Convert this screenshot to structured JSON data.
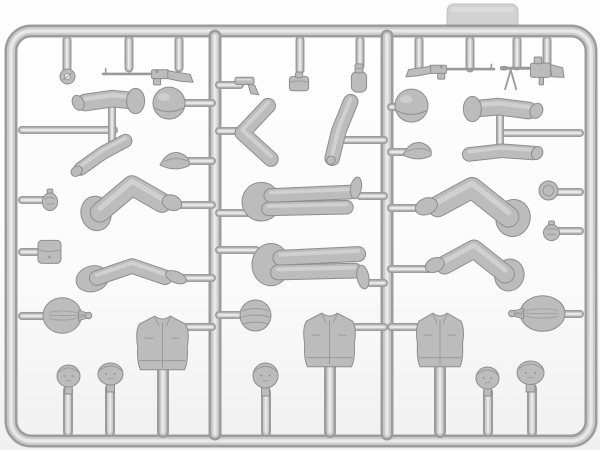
{
  "photo": {
    "subject": "model-kit-sprue-with-soldier-figure-parts",
    "plastic_color_name": "light-gray"
  },
  "palette": {
    "background_top": "#fefefe",
    "background_mid": "#fbfbfb",
    "background_bottom": "#f0f0f0",
    "runner_outline": "#9c9c9c",
    "runner_core": "#cbcbcb",
    "runner_highlight": "#e8e8e8",
    "plastic_base": "#bcbcbc",
    "plastic_edge": "#8d8d8d",
    "plastic_dark": "#999999",
    "plastic_highlight": "#dcdcdc",
    "tab_fill": "#d2d2d2",
    "tab_edge": "#c0c0c0",
    "shadow": "#d6d6d6"
  },
  "sprue": {
    "frame": {
      "x": 11,
      "y": 31,
      "w": 580,
      "h": 410,
      "radius": 20,
      "thickness": 13
    },
    "tab": {
      "x": 447,
      "y": 4,
      "w": 71,
      "h": 32,
      "radius": 7
    },
    "runners": [
      {
        "x": 215,
        "y1": 36,
        "y2": 434,
        "w": 13
      },
      {
        "x": 387,
        "y1": 36,
        "y2": 434,
        "w": 13
      }
    ],
    "stubs": [
      {
        "x": 67,
        "y1": 40,
        "y2": 72
      },
      {
        "x": 129,
        "y1": 40,
        "y2": 68
      },
      {
        "x": 179,
        "y1": 40,
        "y2": 68
      },
      {
        "x": 300,
        "y1": 40,
        "y2": 70
      },
      {
        "x": 360,
        "y1": 40,
        "y2": 66
      },
      {
        "x": 419,
        "y1": 40,
        "y2": 68
      },
      {
        "x": 470,
        "y1": 40,
        "y2": 68
      },
      {
        "x": 517,
        "y1": 40,
        "y2": 66
      },
      {
        "x": 547,
        "y1": 40,
        "y2": 66
      }
    ],
    "branches": [
      {
        "x1": 22,
        "x2": 114,
        "y": 130
      },
      {
        "x1": 22,
        "x2": 44,
        "y": 200
      },
      {
        "x1": 22,
        "x2": 42,
        "y": 252
      },
      {
        "x1": 22,
        "x2": 50,
        "y": 316
      },
      {
        "x1": 183,
        "x2": 212,
        "y": 103
      },
      {
        "x1": 189,
        "x2": 212,
        "y": 161
      },
      {
        "x1": 176,
        "x2": 212,
        "y": 205
      },
      {
        "x1": 182,
        "x2": 212,
        "y": 278
      },
      {
        "x1": 187,
        "x2": 212,
        "y": 327
      },
      {
        "x1": 219,
        "x2": 240,
        "y": 85
      },
      {
        "x1": 219,
        "x2": 239,
        "y": 131
      },
      {
        "x1": 219,
        "x2": 247,
        "y": 213
      },
      {
        "x1": 219,
        "x2": 256,
        "y": 250
      },
      {
        "x1": 219,
        "x2": 244,
        "y": 315
      },
      {
        "x1": 342,
        "x2": 384,
        "y": 140
      },
      {
        "x1": 360,
        "x2": 384,
        "y": 196
      },
      {
        "x1": 364,
        "x2": 384,
        "y": 283
      },
      {
        "x1": 356,
        "x2": 384,
        "y": 327
      },
      {
        "x1": 391,
        "x2": 400,
        "y": 107
      },
      {
        "x1": 391,
        "x2": 407,
        "y": 152
      },
      {
        "x1": 391,
        "x2": 420,
        "y": 208
      },
      {
        "x1": 391,
        "x2": 430,
        "y": 269
      },
      {
        "x1": 391,
        "x2": 419,
        "y": 327
      },
      {
        "x1": 504,
        "x2": 580,
        "y": 133
      },
      {
        "x1": 556,
        "x2": 580,
        "y": 192
      },
      {
        "x1": 558,
        "x2": 580,
        "y": 231
      },
      {
        "x1": 560,
        "x2": 580,
        "y": 314
      }
    ],
    "connectors": [
      {
        "x": 112,
        "y1": 106,
        "y2": 144
      },
      {
        "x": 500,
        "y1": 112,
        "y2": 148
      }
    ],
    "posts": [
      {
        "x": 68,
        "y1": 390,
        "y2": 432,
        "w": 10
      },
      {
        "x": 110,
        "y1": 388,
        "y2": 432,
        "w": 10
      },
      {
        "x": 163,
        "y1": 369,
        "y2": 432,
        "w": 12
      },
      {
        "x": 266,
        "y1": 392,
        "y2": 432,
        "w": 10
      },
      {
        "x": 330,
        "y1": 366,
        "y2": 432,
        "w": 12
      },
      {
        "x": 440,
        "y1": 366,
        "y2": 432,
        "w": 12
      },
      {
        "x": 488,
        "y1": 392,
        "y2": 432,
        "w": 10
      },
      {
        "x": 532,
        "y1": 388,
        "y2": 432,
        "w": 10
      }
    ],
    "parts": [
      {
        "name": "sling-ring",
        "type": "ring",
        "box": [
          60,
          69,
          15,
          15
        ]
      },
      {
        "name": "rifle-bolt-action",
        "type": "rifle",
        "box": [
          103,
          63,
          90,
          26
        ],
        "opt": {
          "muzzle": "left"
        }
      },
      {
        "name": "pistol",
        "type": "pistol",
        "box": [
          234,
          72,
          28,
          24
        ]
      },
      {
        "name": "ammo-pouch-top",
        "type": "binoculars",
        "box": [
          287,
          71,
          24,
          22
        ]
      },
      {
        "name": "canteen",
        "type": "canteen",
        "box": [
          349,
          62,
          20,
          32
        ]
      },
      {
        "name": "rifle-semi-auto",
        "type": "rifle",
        "box": [
          406,
          59,
          88,
          24
        ],
        "opt": {
          "muzzle": "right"
        }
      },
      {
        "name": "machine-gun",
        "type": "mg",
        "box": [
          502,
          57,
          62,
          34
        ],
        "opt": {
          "muzzle": "left"
        }
      },
      {
        "name": "upper-arm-left-column",
        "type": "armH",
        "box": [
          74,
          86,
          70,
          30
        ],
        "opt": {
          "hand": "left"
        }
      },
      {
        "name": "forearm-left-column",
        "type": "armBent",
        "box": [
          70,
          136,
          66,
          40
        ]
      },
      {
        "name": "helmet-left-column",
        "type": "helmet",
        "box": [
          153,
          88,
          32,
          29
        ]
      },
      {
        "name": "side-cap-left-column",
        "type": "cap",
        "box": [
          160,
          150,
          32,
          22
        ]
      },
      {
        "name": "bent-arm-middle-column",
        "type": "armV",
        "box": [
          235,
          102,
          46,
          62
        ]
      },
      {
        "name": "forearm-middle-column",
        "type": "armDiag",
        "box": [
          319,
          97,
          44,
          68
        ]
      },
      {
        "name": "helmet-right-column",
        "type": "helmet",
        "box": [
          395,
          90,
          33,
          30
        ]
      },
      {
        "name": "side-cap-right-column",
        "type": "cap",
        "box": [
          403,
          140,
          31,
          22
        ]
      },
      {
        "name": "upper-arm-right-column",
        "type": "armH",
        "box": [
          463,
          94,
          78,
          30
        ],
        "opt": {
          "hand": "right"
        }
      },
      {
        "name": "forearm-right-column",
        "type": "armH2",
        "box": [
          463,
          139,
          78,
          28
        ],
        "opt": {
          "hand": "right"
        }
      },
      {
        "name": "bent-legs-left-1",
        "type": "legsBent",
        "box": [
          82,
          180,
          100,
          54
        ],
        "opt": {
          "foot": "right"
        }
      },
      {
        "name": "prone-legs-middle-1",
        "type": "legsProne",
        "box": [
          242,
          182,
          120,
          42
        ],
        "opt": {
          "boot": "up"
        }
      },
      {
        "name": "bent-legs-right-1",
        "type": "legsBent",
        "box": [
          415,
          182,
          114,
          58
        ],
        "opt": {
          "foot": "left"
        }
      },
      {
        "name": "mess-tin-lid",
        "type": "disc",
        "box": [
          539,
          181,
          19,
          19
        ]
      },
      {
        "name": "grenade-left",
        "type": "grenade",
        "box": [
          40,
          189,
          20,
          22
        ]
      },
      {
        "name": "pouch-left",
        "type": "pouch",
        "box": [
          37,
          237,
          25,
          28
        ]
      },
      {
        "name": "bent-legs-left-2",
        "type": "legsBent",
        "box": [
          77,
          254,
          110,
          40
        ],
        "opt": {
          "foot": "right",
          "flat": true
        }
      },
      {
        "name": "prone-legs-middle-2",
        "type": "legsProne",
        "box": [
          252,
          243,
          118,
          46
        ],
        "opt": {
          "boot": "down"
        }
      },
      {
        "name": "bent-legs-right-2",
        "type": "legsBent",
        "box": [
          425,
          244,
          98,
          50
        ],
        "opt": {
          "foot": "left"
        }
      },
      {
        "name": "grenade-right",
        "type": "grenade",
        "box": [
          541,
          221,
          21,
          20
        ]
      },
      {
        "name": "duffel-sack-left",
        "type": "sack",
        "box": [
          43,
          297,
          48,
          37
        ],
        "opt": {
          "tie": "right"
        }
      },
      {
        "name": "wrapped-helmet",
        "type": "helmetWrap",
        "box": [
          240,
          300,
          31,
          31
        ]
      },
      {
        "name": "duffel-sack-right",
        "type": "sack",
        "box": [
          509,
          295,
          56,
          37
        ],
        "opt": {
          "tie": "left"
        }
      },
      {
        "name": "torso-left-column",
        "type": "torso",
        "box": [
          135,
          315,
          55,
          57
        ]
      },
      {
        "name": "torso-middle-column",
        "type": "torso",
        "box": [
          302,
          312,
          55,
          57
        ]
      },
      {
        "name": "torso-right-column",
        "type": "torso",
        "box": [
          415,
          312,
          50,
          57
        ]
      },
      {
        "name": "head-1",
        "type": "head",
        "box": [
          57,
          365,
          23,
          29
        ]
      },
      {
        "name": "head-2",
        "type": "head",
        "box": [
          98,
          363,
          25,
          29
        ]
      },
      {
        "name": "head-3",
        "type": "head",
        "box": [
          253,
          363,
          25,
          33
        ]
      },
      {
        "name": "head-4",
        "type": "head",
        "box": [
          476,
          367,
          23,
          29
        ]
      },
      {
        "name": "head-5",
        "type": "head",
        "box": [
          517,
          361,
          27,
          31
        ]
      }
    ]
  }
}
